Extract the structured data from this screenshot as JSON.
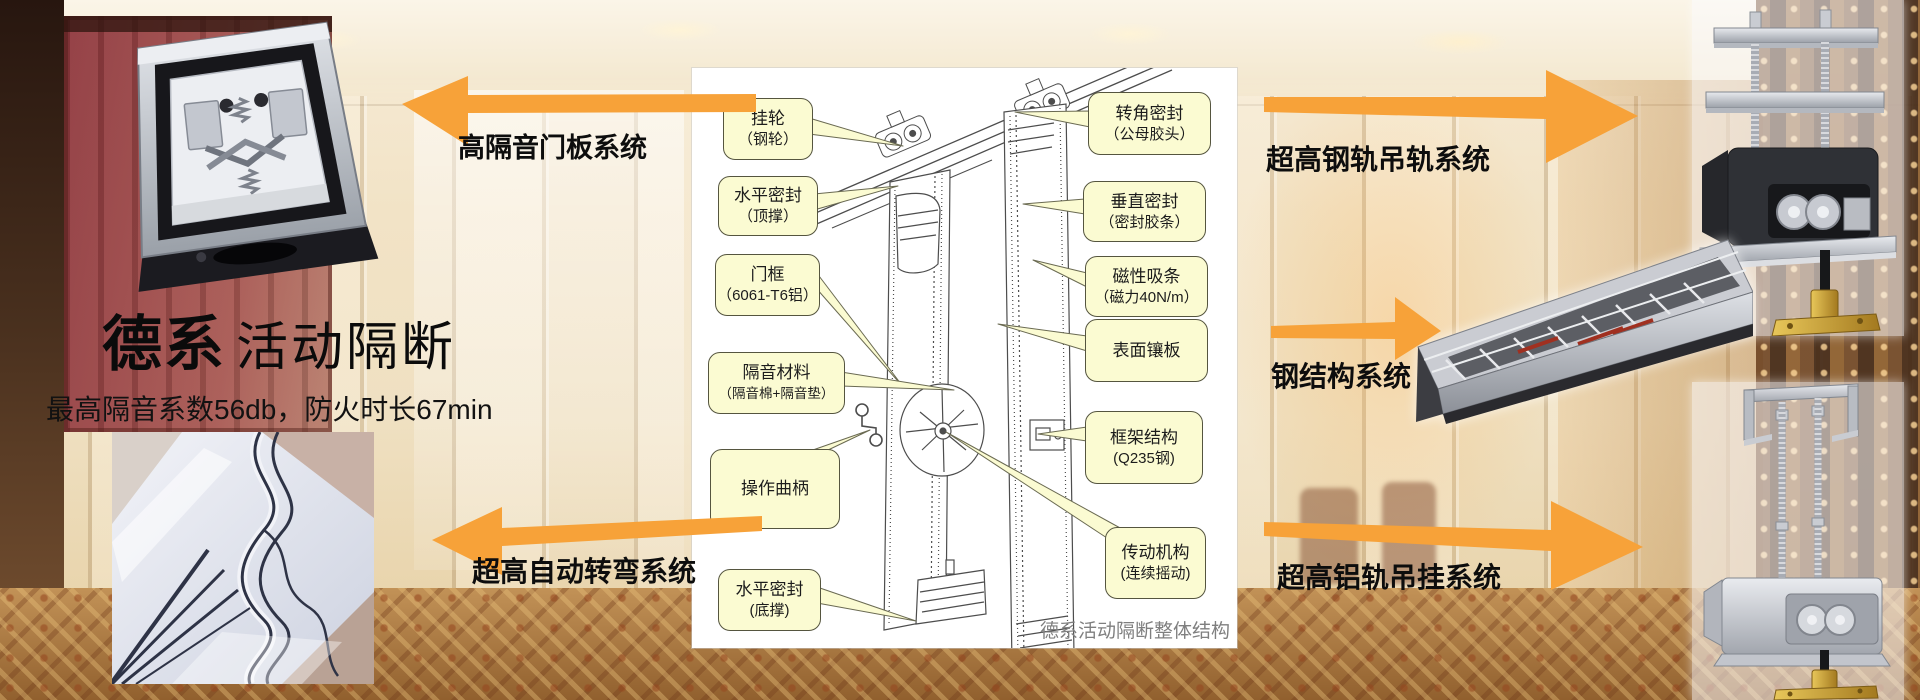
{
  "header": {
    "brand_bold": "德系",
    "brand_rest": "活动隔断",
    "subtitle": "最高隔音系数56db，防火时长67min"
  },
  "arrows": {
    "left_top": "高隔音门板系统",
    "left_bottom": "超高自动转弯系统",
    "right_top": "超高钢轨吊轨系统",
    "right_middle": "钢结构系统",
    "right_bottom": "超高铝轨吊挂系统"
  },
  "diagram": {
    "caption": "德系活动隔断整体结构",
    "callouts": {
      "hanging_wheel": {
        "l1": "挂轮",
        "l2": "（钢轮）"
      },
      "top_seal": {
        "l1": "水平密封",
        "l2": "（顶撑）"
      },
      "door_frame": {
        "l1": "门框",
        "l2": "（6061-T6铝）"
      },
      "sound_material": {
        "l1": "隔音材料",
        "l2": "（隔音棉+隔音垫）"
      },
      "crank": {
        "l1": "操作曲柄",
        "l2": ""
      },
      "bottom_seal": {
        "l1": "水平密封",
        "l2": "(底撑)"
      },
      "corner_seal": {
        "l1": "转角密封",
        "l2": "（公母胶头）"
      },
      "vertical_seal": {
        "l1": "垂直密封",
        "l2": "（密封胶条）"
      },
      "magnetic_strip": {
        "l1": "磁性吸条",
        "l2": "（磁力40N/m）"
      },
      "surface_panel": {
        "l1": "表面镶板",
        "l2": ""
      },
      "frame_structure": {
        "l1": "框架结构",
        "l2": "(Q235钢)"
      },
      "drive_mechanism": {
        "l1": "传动机构",
        "l2": "(连续摇动)"
      }
    }
  },
  "colors": {
    "arrow": "#F7A239",
    "callout_bg": "#FBFBD2",
    "callout_border": "#55553f"
  }
}
